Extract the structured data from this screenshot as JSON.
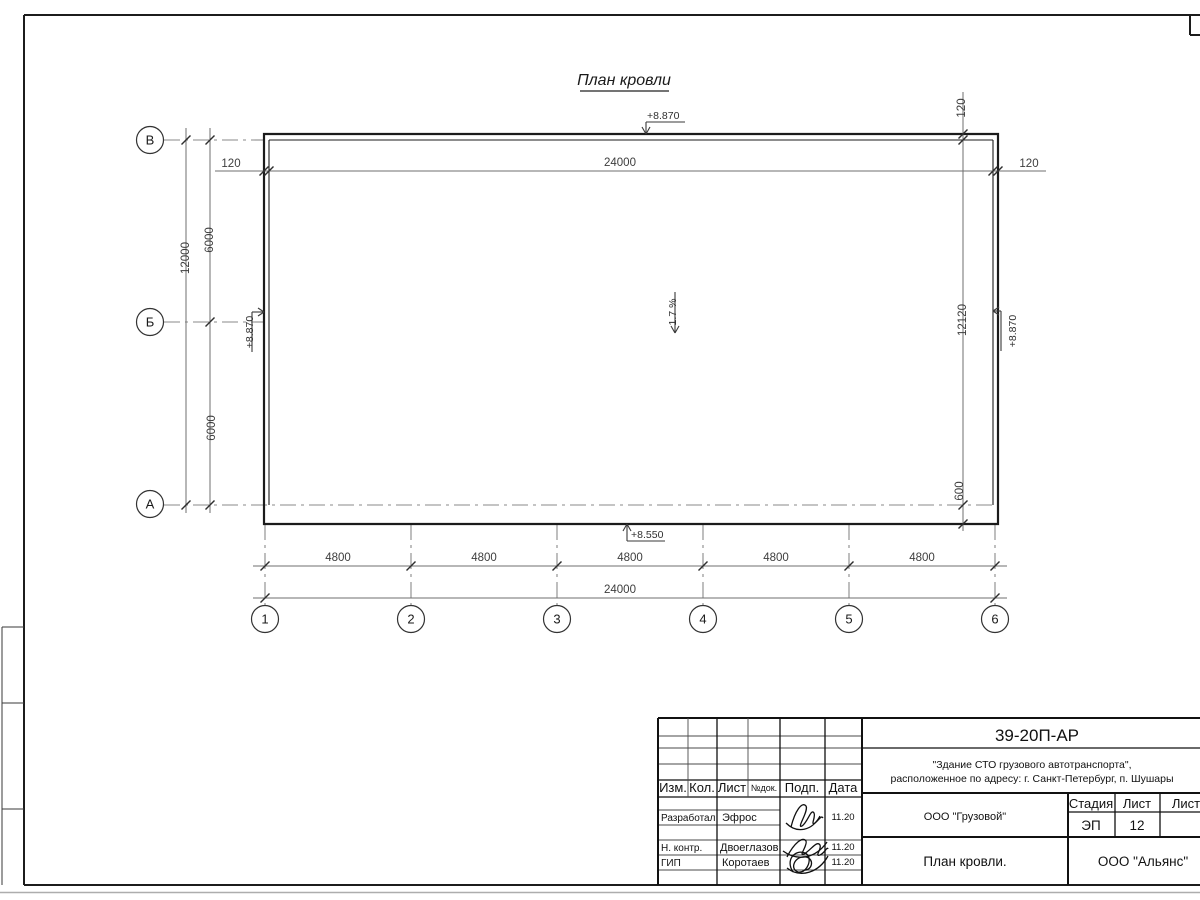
{
  "drawing": {
    "title": "План кровли",
    "slope_label": "1.7 %",
    "row_axes": [
      "В",
      "Б",
      "А"
    ],
    "col_axes": [
      "1",
      "2",
      "3",
      "4",
      "5",
      "6"
    ],
    "dims": {
      "total_width": "24000",
      "bay": [
        "4800",
        "4800",
        "4800",
        "4800",
        "4800"
      ],
      "total_depth": "12000",
      "depth_bay": [
        "6000",
        "6000"
      ],
      "roof_depth": "12120",
      "overhang": "600",
      "parapet": "120"
    },
    "elevations": {
      "parapet_top": "+8.870",
      "eave": "+8.550"
    }
  },
  "title_block": {
    "doc_number": "39-20П-АР",
    "project_line1": "\"Здание СТО грузового автотранспорта\",",
    "project_line2": "расположенное по адресу: г. Санкт-Петербург, п. Шушары",
    "columns": [
      "Изм.",
      "Кол.",
      "Лист",
      "№док.",
      "Подп.",
      "Дата"
    ],
    "signature_rows": [
      {
        "role": "Разработал",
        "name": "Эфрос",
        "date": "11.20"
      },
      {
        "role": "Н. контр.",
        "name": "Двоеглазов",
        "date": "11.20"
      },
      {
        "role": "ГИП",
        "name": "Коротаев",
        "date": "11.20"
      }
    ],
    "client": "ООО \"Грузовой\"",
    "stage_label": "Стадия",
    "sheet_label": "Лист",
    "sheets_label": "Листов",
    "stage": "ЭП",
    "sheet_number": "12",
    "sheet_title": "План кровли.",
    "company": "ООО \"Альянс\""
  }
}
